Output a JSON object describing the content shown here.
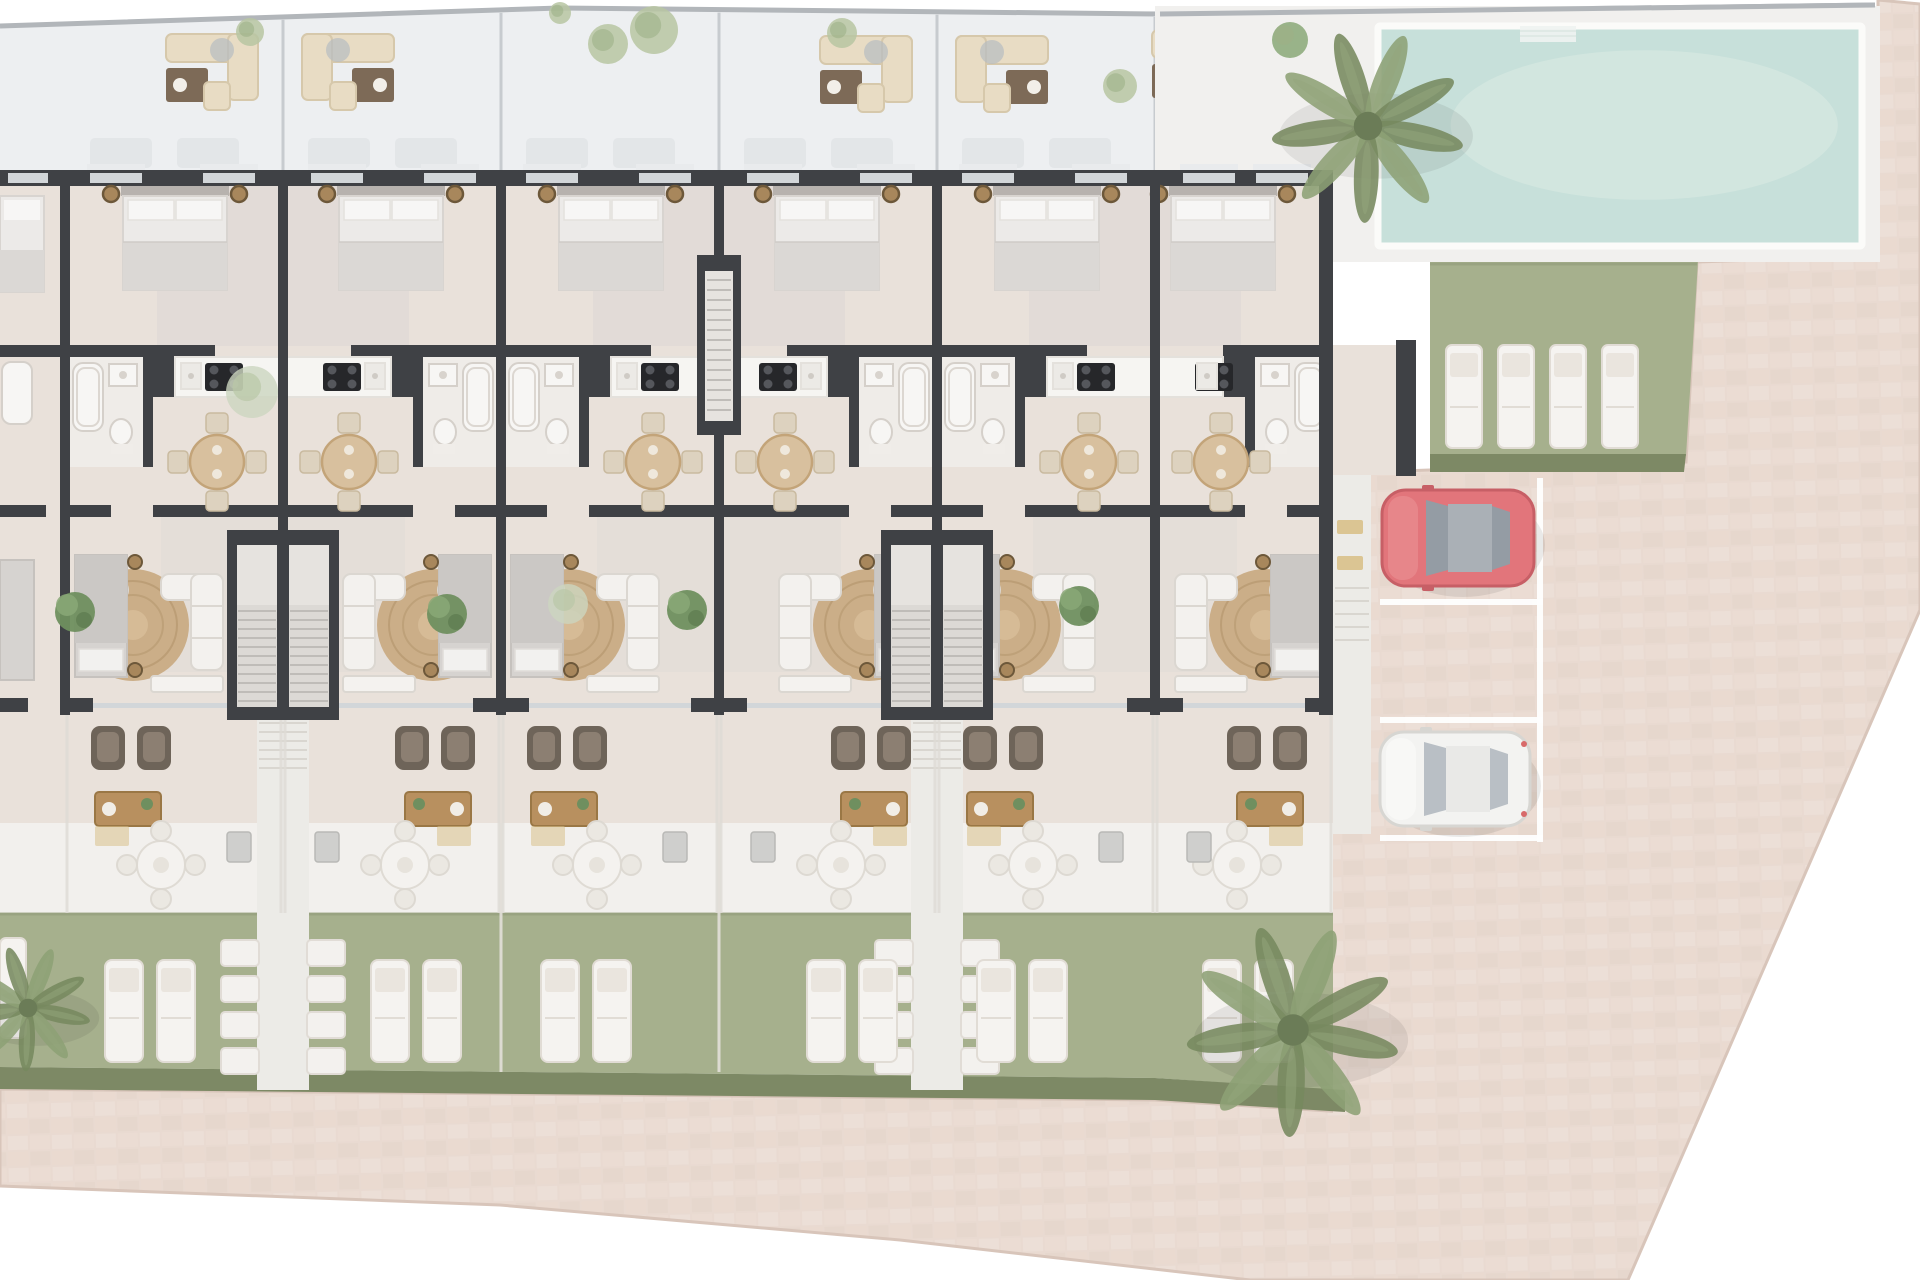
{
  "palette": {
    "wall": "#3f4145",
    "floor": "#e9e1da",
    "floorShadow": "#dcd6d3",
    "bathFloor": "#efece8",
    "roof": "#edeff1",
    "roofLine": "#c7cbcf",
    "boundary": "#b2b6ba",
    "glass": "#d2d6d9",
    "sill": "#e9ebed",
    "bedLinen": "#eceae8",
    "bedDuvet": "#dbd8d5",
    "bedFrame": "#b7b2ae",
    "pillow": "#f7f6f5",
    "stool": "#a8875c",
    "stoolRing": "#6d583a",
    "fixture": "#f7f6f4",
    "fixStroke": "#d5d0ca",
    "counter": "#f6f5f2",
    "counterStroke": "#e4e1dc",
    "cooktop": "#26272a",
    "burner": "#55575c",
    "tableWood": "#d8c09e",
    "tableRim": "#c3a479",
    "chair": "#ddd2bf",
    "chairStroke": "#c9ba9f",
    "rug": "#cbae88",
    "rugLine": "#b5976f",
    "sofa": "#f3f1ee",
    "sofaStroke": "#dbd7d1",
    "bed2": "#d6d3d0",
    "bed2duv": "#cbc8c5",
    "armchair": "#6e6459",
    "armchairIn": "#8c7f72",
    "wood": "#b8905f",
    "woodStroke": "#9a7745",
    "patio": "#f2f0ed",
    "patioChair": "#ebe8e2",
    "grass": "#a6b08d",
    "grassEdge": "#96a17f",
    "hedge": "#7d8965",
    "lounger": "#f5f3f0",
    "loungerStroke": "#e1dcd5",
    "loungerBand": "#eae5de",
    "pool": "#c7e0da",
    "poolLight": "#d8e9e3",
    "deck": "#f1f0ee",
    "pavement": "#e9dad1",
    "paveAlt1": "#e4d3c9",
    "paveAlt2": "#efe3db",
    "paveEdge": "#d8c5ba",
    "parkLine": "#ffffff",
    "carRed": "#e2757b",
    "carRedStroke": "#c75f66",
    "carGlass": "#949ca4",
    "carRoof": "#aab0b6",
    "carWhite": "#f3f3f1",
    "carWhiteStroke": "#d7d6d2",
    "carWhiteGlass": "#b9bfc5",
    "palm": "#8da075",
    "palmDark": "#76895f",
    "bushA": "#6f8f5f",
    "bushB": "#8aa877",
    "sage": "#ccd6bf",
    "walk": "#ecebe7",
    "walkLine": "#d9d6d0",
    "stepFill": "#dcd9d5",
    "stepLine": "#bfbcb8",
    "shaftIn": "#e6e3df",
    "stone": "#f3f1ee",
    "stoneStroke": "#e1dcd6",
    "mat": "#d9c18a",
    "shadow": "#000000"
  },
  "site": {
    "boundary_top": [
      [
        0,
        26
      ],
      [
        560,
        8
      ],
      [
        1160,
        14
      ],
      [
        1875,
        5
      ]
    ],
    "roof_band": [
      [
        0,
        26
      ],
      [
        560,
        8
      ],
      [
        1160,
        14
      ],
      [
        1160,
        170
      ],
      [
        0,
        170
      ]
    ],
    "roof_dividers_x": [
      283,
      501,
      719,
      937,
      1155
    ],
    "roof_sofa_sets": [
      {
        "x": 212,
        "y": 80,
        "mir": false
      },
      {
        "x": 348,
        "y": 80,
        "mir": true
      },
      {
        "x": 866,
        "y": 82,
        "mir": false
      },
      {
        "x": 1002,
        "y": 82,
        "mir": true
      },
      {
        "x": 1198,
        "y": 76,
        "mir": false
      }
    ],
    "roof_trees": [
      {
        "x": 250,
        "y": 32,
        "r": 14
      },
      {
        "x": 608,
        "y": 44,
        "r": 20
      },
      {
        "x": 654,
        "y": 30,
        "r": 24
      },
      {
        "x": 842,
        "y": 33,
        "r": 15
      },
      {
        "x": 1120,
        "y": 86,
        "r": 17
      },
      {
        "x": 560,
        "y": 13,
        "r": 11
      }
    ],
    "pool": {
      "deck": [
        1155,
        6,
        725,
        256
      ],
      "x": 1378,
      "y": 26,
      "w": 484,
      "h": 220,
      "steps": [
        1520,
        26,
        56,
        16
      ]
    },
    "lawn": {
      "pts": [
        [
          1430,
          262
        ],
        [
          1698,
          262
        ],
        [
          1686,
          456
        ],
        [
          1430,
          456
        ]
      ],
      "hedge": [
        [
          1430,
          454
        ],
        [
          1686,
          454
        ],
        [
          1684,
          472
        ],
        [
          1430,
          472
        ]
      ],
      "loungers": [
        1446,
        1498,
        1550,
        1602
      ],
      "lounger_y": 345
    },
    "parking": {
      "line_x": 1540,
      "row_lines_y": [
        602,
        720,
        838
      ],
      "x0": 1380,
      "cars": [
        {
          "kind": "red",
          "x": 1382,
          "y": 490,
          "w": 152,
          "h": 96
        },
        {
          "kind": "white",
          "x": 1380,
          "y": 732,
          "w": 150,
          "h": 94
        }
      ]
    },
    "side_path": {
      "x": 1333,
      "y": 388,
      "w": 38,
      "h": 446,
      "mats": [
        [
          1337,
          520
        ],
        [
          1337,
          556
        ]
      ]
    },
    "pavement_path": "M1878,0 L1920,4 L1920,610 L1628,1280 L1250,1280 L900,1240 L500,1205 L0,1186 L0,1089 L1155,1100 L1345,1112 L1345,834 L1333,834 L1333,388 L1371,388 L1371,472 L1430,470 L1686,462 L1697,262 L1878,256 Z",
    "patch": [
      1333,
      830,
      14,
      292
    ],
    "bands": {
      "floor": [
        0,
        170,
        1333,
        653
      ],
      "patio": [
        0,
        823,
        1333,
        90
      ],
      "garden_main": [
        [
          0,
          913
        ],
        [
          1155,
          913
        ],
        [
          1155,
          1078
        ],
        [
          0,
          1067
        ]
      ],
      "garden_end": [
        [
          1155,
          913
        ],
        [
          1333,
          913
        ],
        [
          1333,
          1090
        ],
        [
          1155,
          1078
        ]
      ],
      "hedge_main": [
        [
          0,
          1067
        ],
        [
          1155,
          1078
        ],
        [
          1155,
          1100
        ],
        [
          0,
          1089
        ]
      ],
      "hedge_end": [
        [
          1155,
          1078
        ],
        [
          1345,
          1090
        ],
        [
          1345,
          1112
        ],
        [
          1155,
          1100
        ]
      ]
    },
    "fence_x": [
      501,
      719
    ],
    "right_wall": [
      1319,
      170,
      14,
      545
    ],
    "wing": {
      "floor": [
        1333,
        345,
        63,
        130
      ],
      "wall": [
        1396,
        340,
        20,
        136
      ]
    },
    "terrace_bushes": [
      [
        75,
        612
      ],
      [
        447,
        614
      ],
      [
        687,
        610
      ],
      [
        1079,
        606
      ]
    ],
    "sage_trees": [
      [
        252,
        392,
        26
      ],
      [
        568,
        604,
        20
      ]
    ],
    "palms": [
      {
        "x": 1368,
        "y": 126,
        "s": 95
      },
      {
        "x": 1293,
        "y": 1030,
        "s": 105
      },
      {
        "x": 28,
        "y": 1008,
        "s": 62
      }
    ],
    "deck_bush": [
      1290,
      40,
      18
    ]
  },
  "units": [
    {
      "id": 1,
      "x": 65,
      "w": 218,
      "mirrored": false
    },
    {
      "id": 2,
      "x": 283,
      "w": 218,
      "mirrored": true
    },
    {
      "id": 3,
      "x": 501,
      "w": 218,
      "mirrored": false
    },
    {
      "id": 4,
      "x": 719,
      "w": 218,
      "mirrored": true
    },
    {
      "id": 5,
      "x": 937,
      "w": 218,
      "mirrored": false
    },
    {
      "id": 6,
      "x": 1155,
      "w": 178,
      "mirrored": true,
      "end": true
    }
  ],
  "party_walls_x": [
    65,
    283,
    501,
    719,
    937,
    1155
  ],
  "stairwells_x": [
    283,
    937
  ],
  "entry_hall_x": 719,
  "summary": {
    "main_row_units": 5,
    "end_unit": 1,
    "partial_unit_left": 1,
    "garden_loungers_per_unit": 2,
    "pool_loungers": 4,
    "parking_spaces": 3,
    "cars": 2,
    "car_colors": [
      "red",
      "white"
    ],
    "pool": 1,
    "palm_trees": 3
  }
}
